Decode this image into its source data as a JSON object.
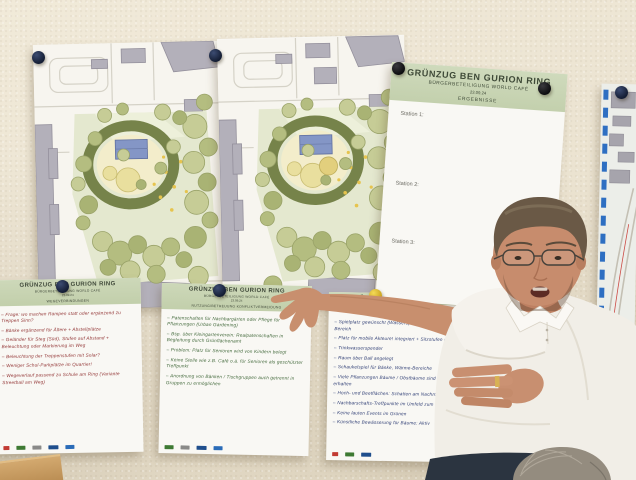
{
  "colors": {
    "wall": "#ece4d2",
    "poster_header_green": "#c8d4b2",
    "ink_red": "#933636",
    "ink_green": "#41683a",
    "ink_blue": "#2e3d74",
    "pin_navy": "#141d33",
    "pin_black": "#0d0d10",
    "pin_yellow": "#e8c832"
  },
  "results_poster": {
    "title": "GRÜNZUG BEN GURION RING",
    "subtitle": "BÜRGERBETEILIGUNG WORLD CAFÉ",
    "date": "23.09.24",
    "section_label": "ERGEBNISSE",
    "stations": [
      "Station 1:",
      "Station 2:",
      "Station 3:"
    ]
  },
  "flipcharts": {
    "left": {
      "title": "GRÜNZUG BEN GURION RING",
      "subtitle": "BÜRGERBETEILIGUNG WORLD CAFÉ",
      "date": "23.09.24",
      "topic": "WEGEVERBINDUNGEN",
      "notes": [
        "Frage: wo machen Rampen statt oder ergänzend zu Treppen Sinn?",
        "Bänke ergänzend für Ältere + Abstellplätze",
        "Geländer für Steg (Süd), Stufen auf Abstand + Beleuchtung oder Markierung im Weg",
        "Beleuchtung der Treppenstufen mit Solar?",
        "Weniger Schul-Parkplätze im Quartier!",
        "Wegeverlauf passend zu Schule am Ring (Variante Streetball am Weg)"
      ]
    },
    "middle": {
      "title": "GRÜNZUG BEN GURION RING",
      "subtitle": "BÜRGERBETEILIGUNG WORLD CAFÉ",
      "date": "23.09.24",
      "topic": "NUTZUNG/BETREUUNG KONFLIKTVERMEIDUNG",
      "notes": [
        "Patenschaften für Nachbargärten oder Pflege für Pflanzungen (Urban Gardening)",
        "Bsp. über Kleingartenverein: Realpatenschaften in Begleitung durch Grünflächenamt",
        "Problem: Platz für Senioren wird von Kindern belegt",
        "Keine Stelle wie z.B. Café o.ä. für Senioren als geschützter Treffpunkt",
        "Anordnung von Bänken / Tischgruppen auch getrennt in Gruppen zu ermöglichen"
      ]
    },
    "right": {
      "title": "GRÜNZUG BEN GURION RING",
      "notes_blue": [
        "Spielplatz gewünscht (Wasserspiel?) + Beach-Tisch-Bereich",
        "Platz für mobile Akteure! integriert + Sitzstufen o.ä.",
        "Trinkwasserspender",
        "Raum über Ball angelegt",
        "Schaukelspiel für Bänke, Wärme-Bereiche",
        "Viele Pflanzungen Bäume / Obstbäume sind zu erhalten",
        "Hoch- und Beetflächen: Schatten am Nachmittag",
        "Nachbarschafts-Treffpunkte im Umfeld zum Nutzen"
      ],
      "notes_red": [
        "Keine lauten Events im Grünen",
        "Künstliche Bewässerung für Bäume: Aktiv"
      ]
    }
  }
}
